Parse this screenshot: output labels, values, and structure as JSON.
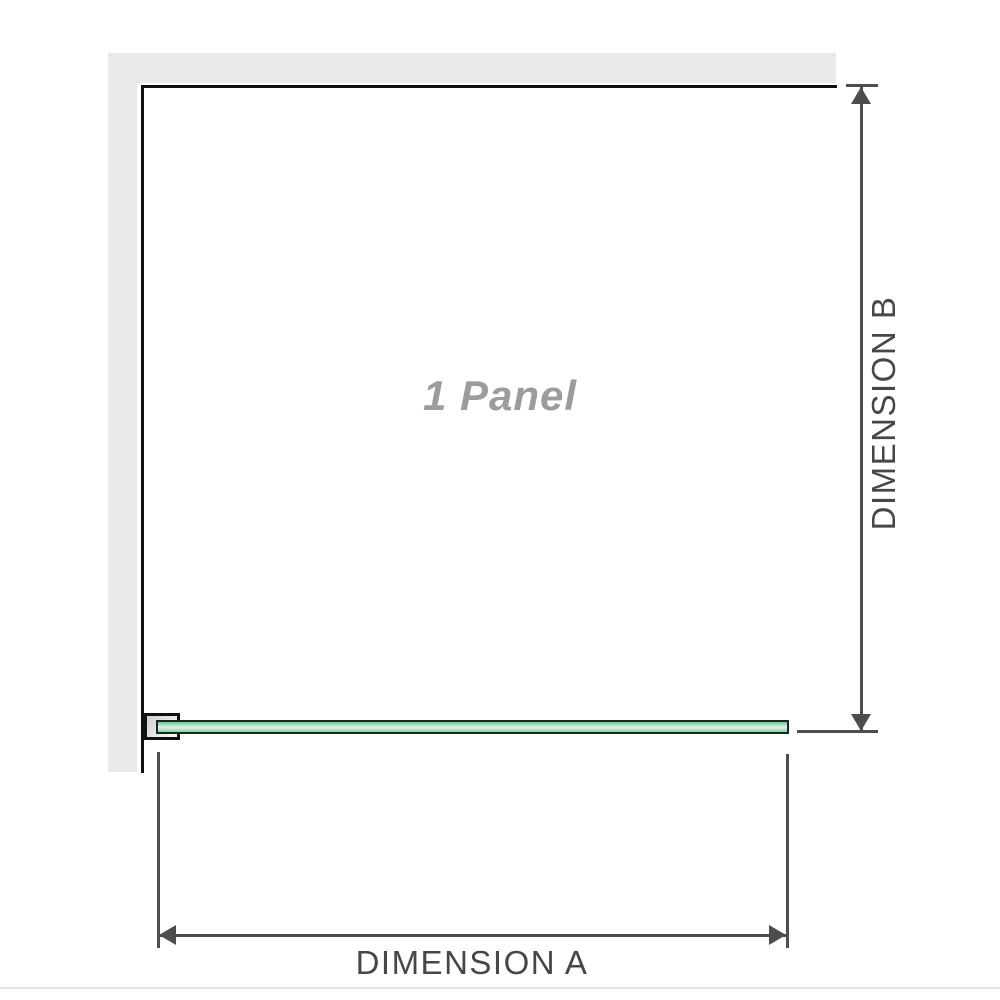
{
  "diagram": {
    "panel_label": "1 Panel",
    "dimensions": {
      "a_label": "DIMENSION A",
      "b_label": "DIMENSION B"
    },
    "colors": {
      "wall_fill": "#e9e9e9",
      "panel_outline": "#101010",
      "dimension_line": "#4d4d4d",
      "dimension_text": "#474747",
      "panel_label_text": "#9c9c9c",
      "glass_outline": "#17291e",
      "glass_green_dark": "#6fc398",
      "glass_green_light": "#daf2e6",
      "bracket_fill": "#e3e3e3",
      "baseline_rule": "#e5e2da"
    }
  }
}
